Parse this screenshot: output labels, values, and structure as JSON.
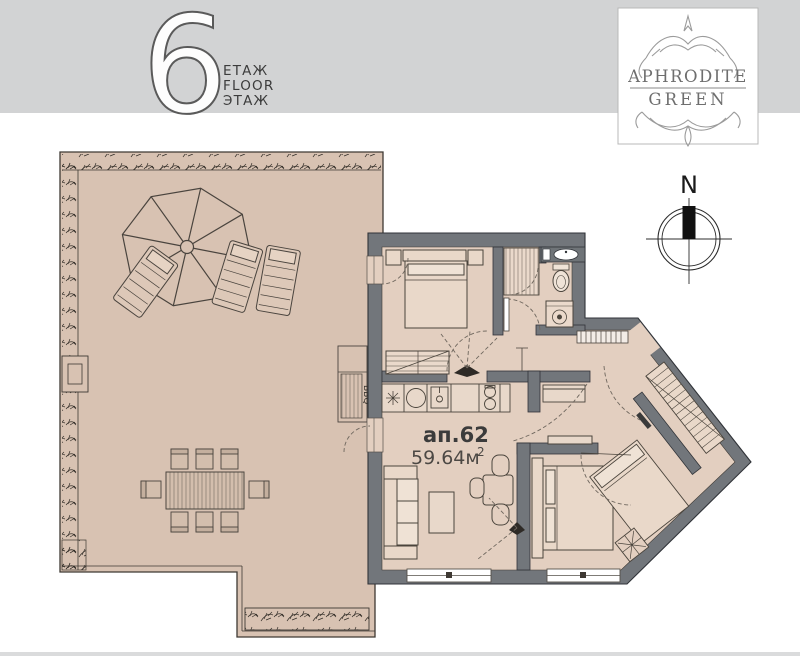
{
  "page": {
    "top_band_color": "#d2d3d4",
    "bottom_band_color": "#dadbdc",
    "background": "#ffffff"
  },
  "header": {
    "floor_number": "6",
    "floor_labels": [
      "ЕТАЖ",
      "FLOOR",
      "ЭТАЖ"
    ]
  },
  "logo": {
    "name_line1": "APHRODITE",
    "name_line2": "GREEN"
  },
  "compass": {
    "north_label": "N"
  },
  "plan": {
    "apartment_label": "ап.62",
    "area_value": "59.64м",
    "area_superscript": "2",
    "bbq_label": "BBQ",
    "colors": {
      "terrace_floor": "#d8c2b2",
      "apartment_floor": "#e3cfc0",
      "walls": "#72767b",
      "outline": "#3e3933",
      "furniture_fill": "#e9d8c9"
    }
  }
}
